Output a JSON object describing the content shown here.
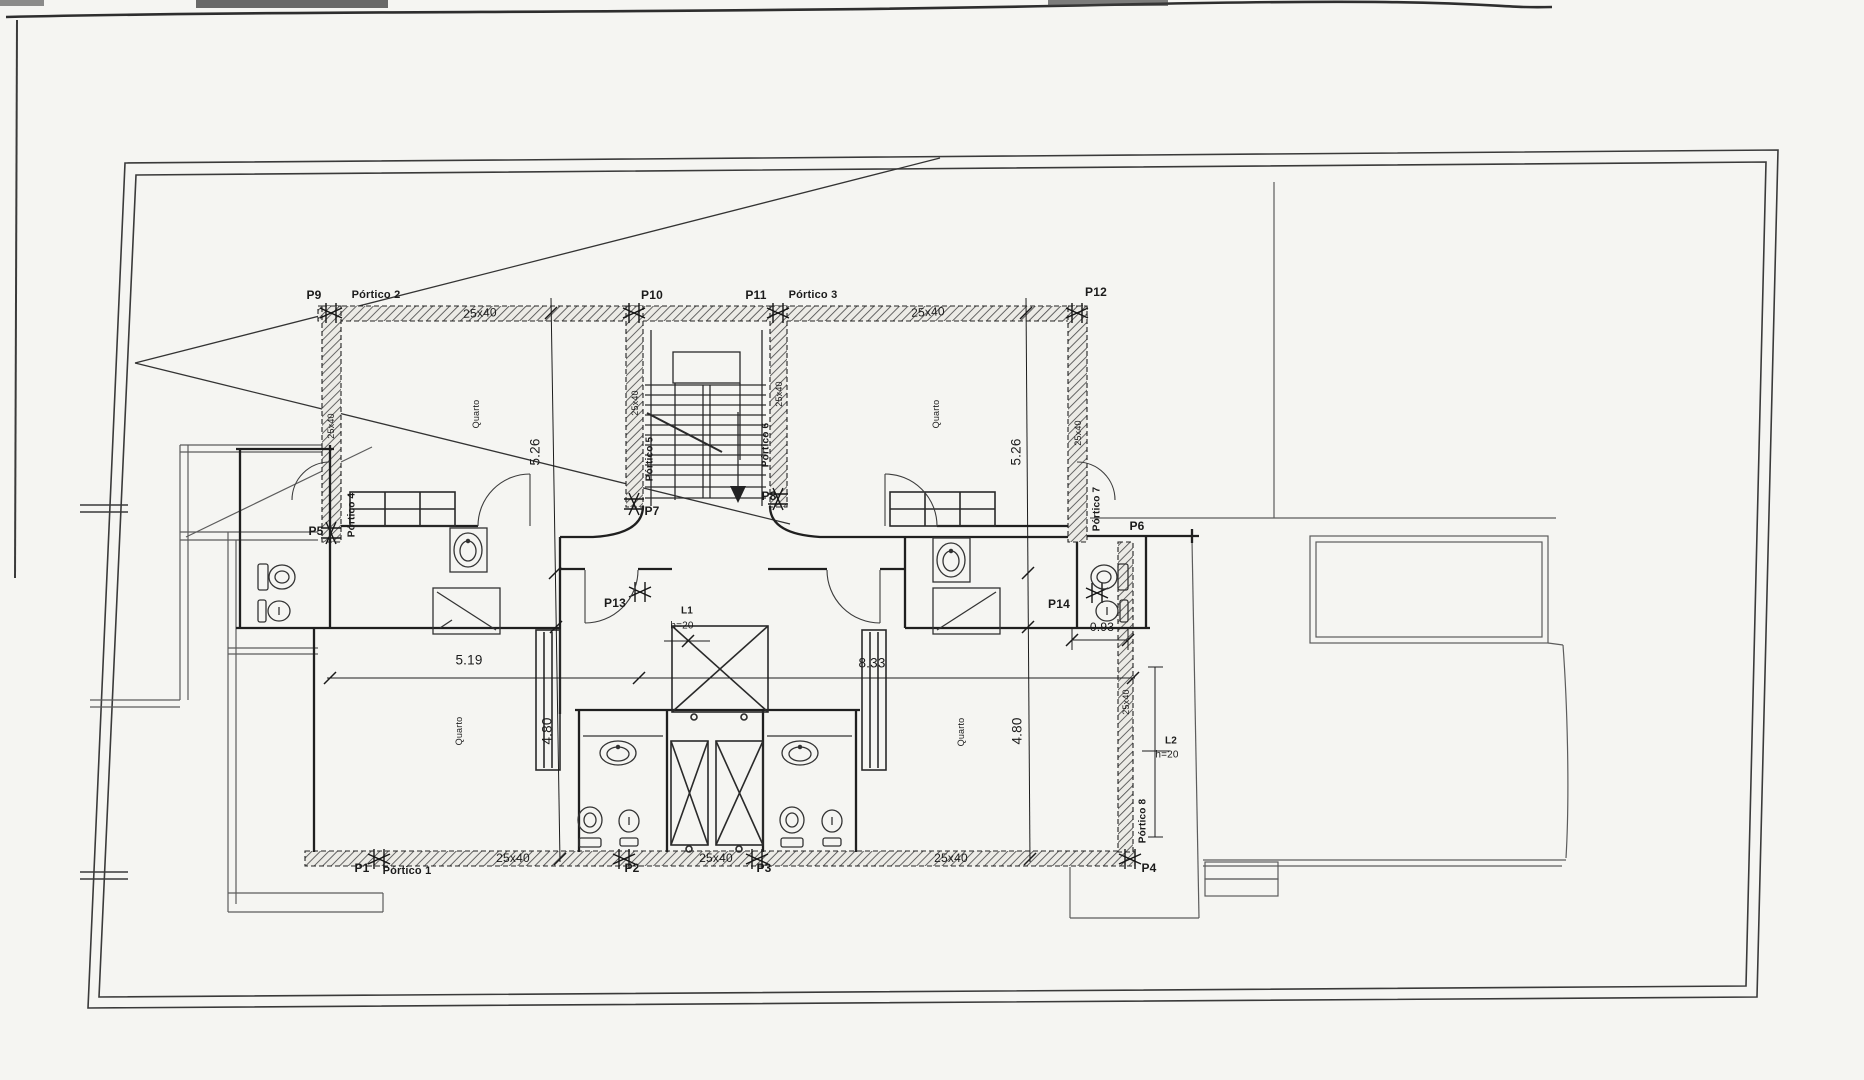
{
  "columns": {
    "p1": "P1",
    "p2": "P2",
    "p3": "P3",
    "p4": "P4",
    "p5": "P5",
    "p6": "P6",
    "p7": "P7",
    "p8": "P8",
    "p9": "P9",
    "p10": "P10",
    "p11": "P11",
    "p12": "P12",
    "p13": "P13",
    "p14": "P14"
  },
  "porticos": {
    "p1": "Pórtico 1",
    "p2": "Pórtico 2",
    "p3": "Pórtico 3",
    "p4": "Pórtico 4",
    "p5": "Pórtico 5",
    "p6": "Pórtico 6",
    "p7": "Pórtico 7",
    "p8": "Pórtico 8"
  },
  "beam_sections": {
    "top_left": "25x40",
    "top_right": "25x40",
    "bottom_left": "25x40",
    "bottom_mid": "25x40",
    "bottom_right": "25x40",
    "col_left": "25x40",
    "col_stair_left": "25x40",
    "col_stair_right": "25x40",
    "col_right": "25x40",
    "col_bottom_right": "25x40"
  },
  "dimensions": {
    "top_left_depth": "5.26",
    "top_right_depth": "5.26",
    "span_left": "5.19",
    "span_right": "8.33",
    "bottom_left_depth": "4.80",
    "bottom_right_depth": "4.80",
    "annex_width": "0.93"
  },
  "levels": {
    "l1": {
      "name": "L1",
      "height": "h=20"
    },
    "l2": {
      "name": "L2",
      "height": "h=20"
    }
  },
  "rooms": {
    "top_left": "Quarto",
    "top_right": "Quarto",
    "bottom_left": "Quarto",
    "bottom_right": "Quarto"
  }
}
